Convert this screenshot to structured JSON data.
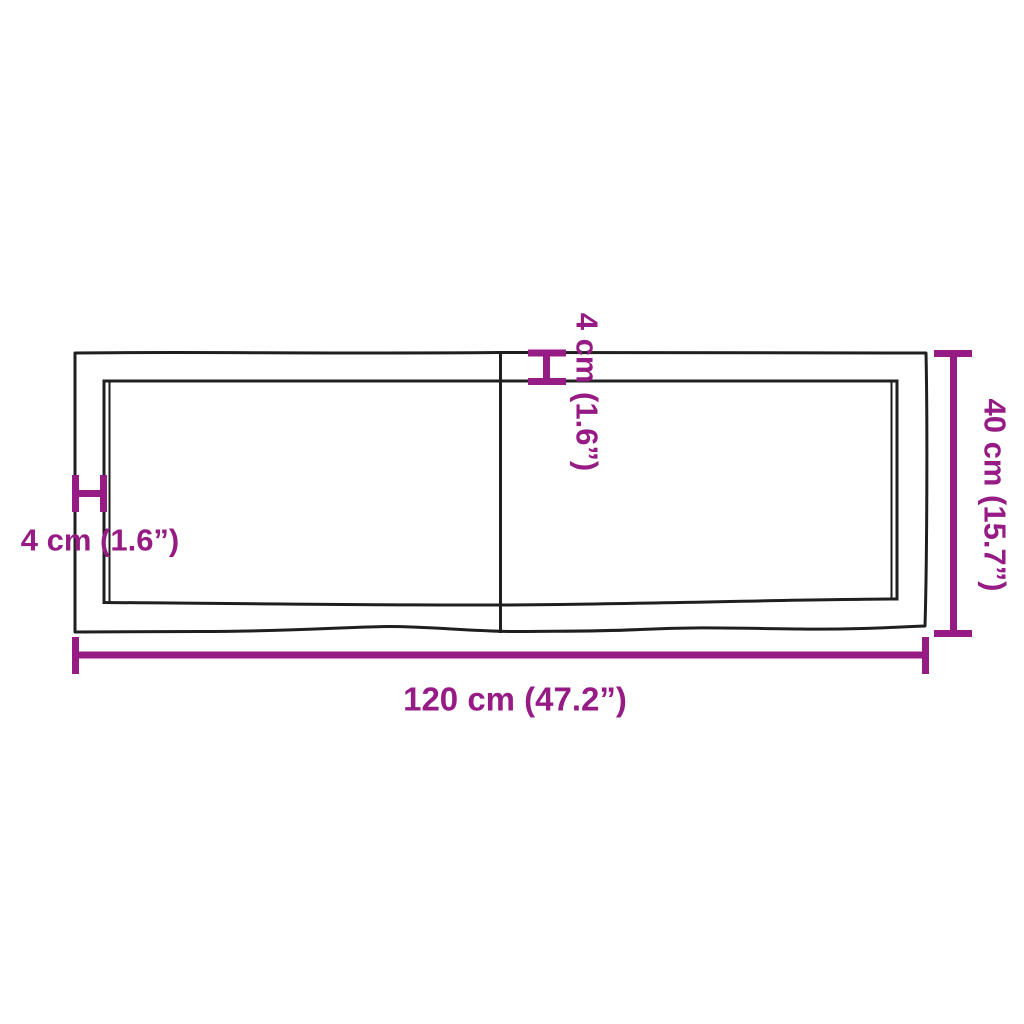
{
  "colors": {
    "accent": "#961b85",
    "line": "#1f1f1f",
    "bg": "#ffffff"
  },
  "diagram": {
    "type": "product-dimension-diagram",
    "view": "board-top-view-with-center-split",
    "labels": {
      "width": "120 cm (47.2”)",
      "height": "40 cm (15.7”)",
      "edge_left": "4 cm (1.6”)",
      "edge_top": "4 cm (1.6”)"
    },
    "measurements": {
      "width_cm": 120,
      "width_in": 47.2,
      "height_cm": 40,
      "height_in": 15.7,
      "edge_cm": 4,
      "edge_in": 1.6
    }
  }
}
